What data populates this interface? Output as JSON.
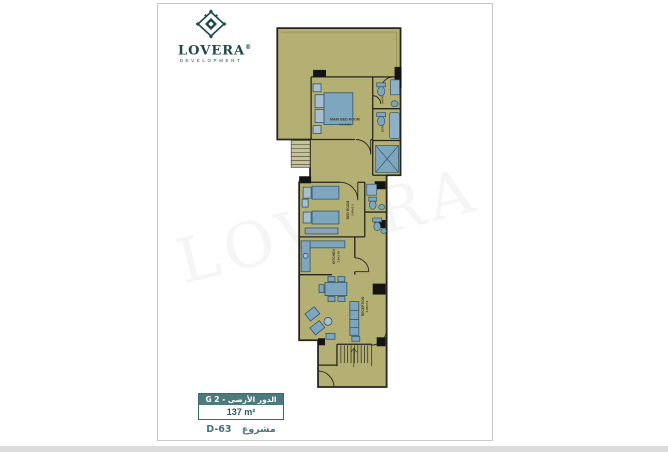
{
  "brand": {
    "name": "LOVERA",
    "registered": "®",
    "tagline": "DEVELOPMENT",
    "color": "#1c4a4c"
  },
  "watermark": {
    "text": "LOVERA"
  },
  "floor_badge": {
    "floor_label": "الدور الأرضى - G 2",
    "area": "137 m²",
    "header_bg": "#4c797b"
  },
  "project": {
    "label": "مشروع",
    "code": "D-63"
  },
  "plan": {
    "colors": {
      "floor": "#b4b074",
      "walls": "#26261c",
      "furniture": "#7fa6bf",
      "furniture_light": "#a6bfd1"
    },
    "rooms": {
      "main_bedroom": {
        "name": "MAIN BED ROOM",
        "dims": "4.0×5.55"
      },
      "bedroom": {
        "name": "BED ROOM",
        "dims": "3.45×3.0"
      },
      "kitchen": {
        "name": "KITCHEN",
        "dims": "2.8×3.45"
      },
      "reception": {
        "name": "RECEPTION",
        "dims": "3.85×7.9"
      },
      "bath_top": {
        "name": "BATH"
      },
      "bath_mid": {
        "name": "BATH"
      }
    }
  }
}
